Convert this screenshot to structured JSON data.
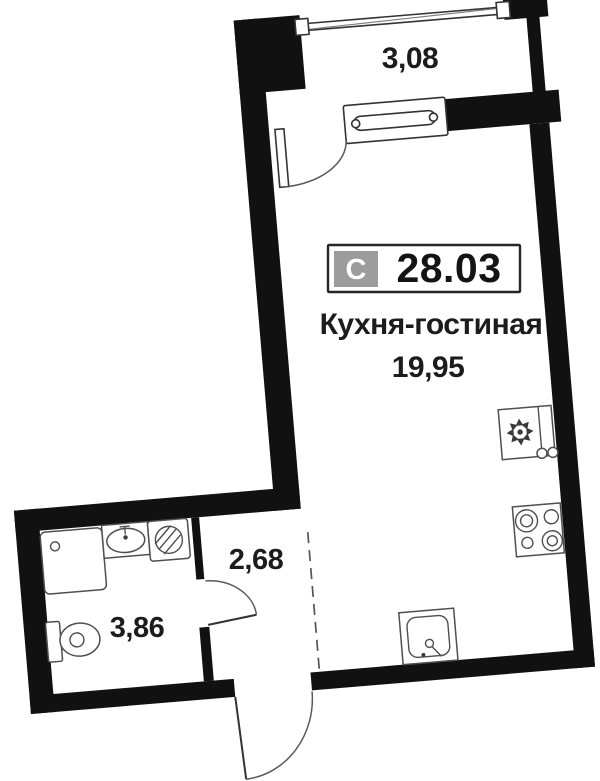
{
  "unit_badge": {
    "type_letter": "С",
    "total_area": "28.03"
  },
  "labels": {
    "loggia_width": "3,08",
    "main_room_name": "Кухня-гостиная",
    "main_room_area": "19,95",
    "hallway_area": "2,68",
    "bathroom_area": "3,86"
  },
  "plan": {
    "rotation_deg": -4.8,
    "rooms": [
      {
        "name": "Кухня-гостиная",
        "area_m2": "19,95"
      },
      {
        "name": "hallway",
        "area_m2": "2,68"
      },
      {
        "name": "bathroom",
        "area_m2": "3,86"
      },
      {
        "name": "loggia",
        "width_m": "3,08"
      }
    ],
    "fixtures": [
      "fridge-icon",
      "cooktop-icon",
      "kitchen-sink-icon",
      "shower-icon",
      "washbasin-icon",
      "washing-machine-icon",
      "toilet-icon",
      "balcony-door-icon",
      "bathroom-door-icon",
      "entrance-door-icon",
      "loggia-window-icon"
    ]
  },
  "colors": {
    "background": "#ffffff",
    "wall": "#111111",
    "fixture_line": "#4f4f4f",
    "text": "#1c1c1c",
    "badge_gray": "#9c9c9c",
    "badge_border": "#262626",
    "dashed_zone_line": "#555555"
  }
}
